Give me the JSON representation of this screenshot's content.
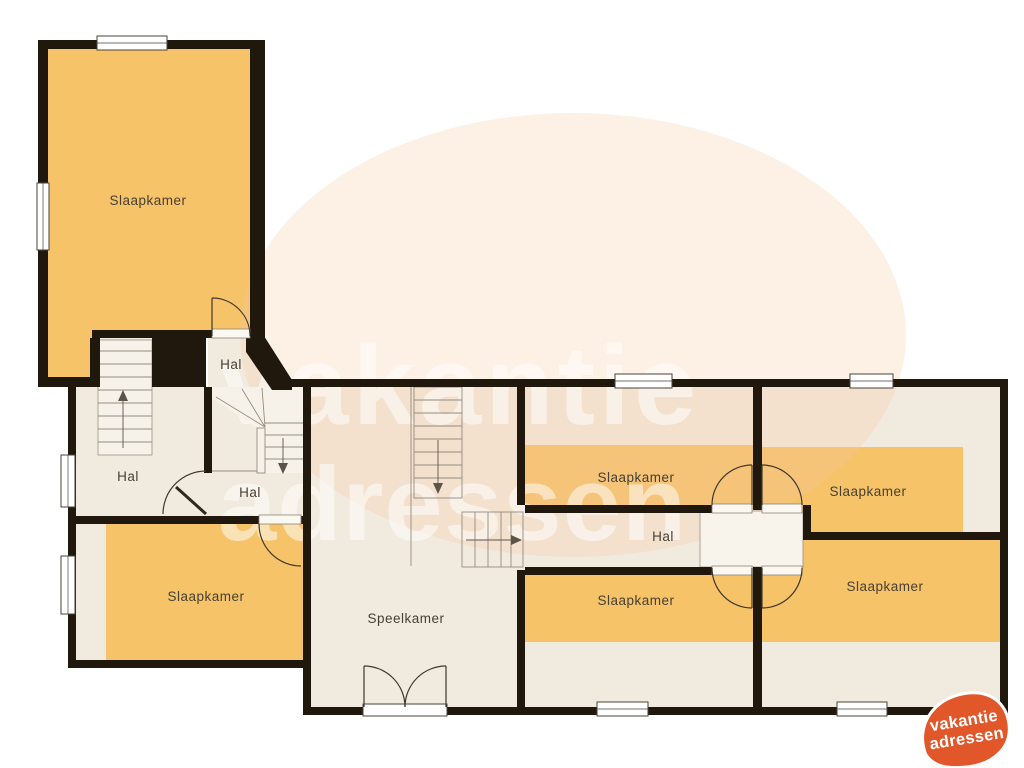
{
  "plan": {
    "rooms": [
      {
        "id": "bedroom-top-left",
        "label": "Slaapkamer"
      },
      {
        "id": "bedroom-bottom-left",
        "label": "Slaapkamer"
      },
      {
        "id": "bedroom-middle-top",
        "label": "Slaapkamer"
      },
      {
        "id": "bedroom-right-top",
        "label": "Slaapkamer"
      },
      {
        "id": "bedroom-middle-bottom",
        "label": "Slaapkamer"
      },
      {
        "id": "bedroom-right-bottom",
        "label": "Slaapkamer"
      },
      {
        "id": "hall-upper",
        "label": "Hal"
      },
      {
        "id": "hall-left",
        "label": "Hal"
      },
      {
        "id": "hall-stairs",
        "label": "Hal"
      },
      {
        "id": "hall-corridor",
        "label": "Hal"
      },
      {
        "id": "playroom",
        "label": "Speelkamer"
      }
    ],
    "colors": {
      "wall": "#20170d",
      "room_orange": "#f6c368",
      "room_cream": "#f1ebdf",
      "stair_fill": "#f7f2e9",
      "watermark_blob": "#f7c9a3"
    }
  },
  "watermark": {
    "line1": "vakantie",
    "line2": "adressen"
  },
  "logo": {
    "line1": "vakantie",
    "line2": "adressen",
    "color": "#e2572a",
    "text_color": "#ffffff"
  }
}
